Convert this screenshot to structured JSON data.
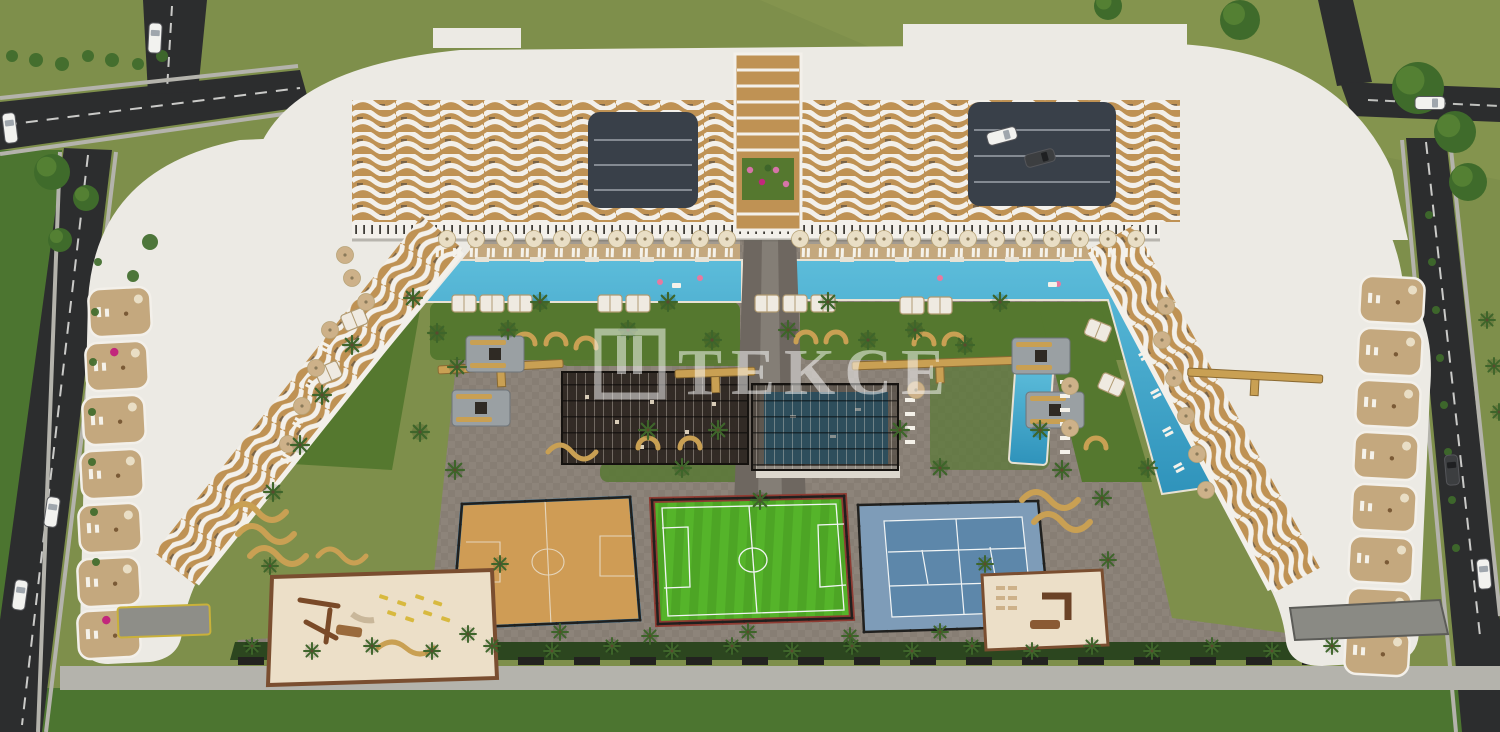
{
  "watermark": {
    "text": "TEKCE"
  },
  "colors": {
    "grass": "#7e8f4b",
    "grassLight": "#8a9a52",
    "lawn": "#4c7530",
    "road": "#2c2d2e",
    "roadLine": "#e6e6e3",
    "sidewalk": "#b4b3ac",
    "building": "#eceae4",
    "facadeTan": "#bf9254",
    "facadeWhite": "#f3f0ea",
    "facadeDark": "#4c463e",
    "atrium": "#394049",
    "arcadeTick": "#3f3c37",
    "hedge": "#2c461f",
    "garden": "#55782f",
    "palm": "#3e652a",
    "tree": "#3f6b2b",
    "treeHi": "#69953c",
    "deck": "#c4a87e",
    "pavement": "#8d847a",
    "path2": "#6e6760",
    "walk": "#a39b90",
    "pool": "#53b5d6",
    "poolDeep": "#2f93bb",
    "poolEdge": "#e8e2d4",
    "canopy": "#2f2822",
    "canopyPool": "#2e6d8c",
    "cabana": "#efeae1",
    "cabanaTrim": "#b09a72",
    "umbrella": "#e9dec5",
    "umbrellaTan": "#cdb189",
    "bench": "#c9a053",
    "firepad": "#9aa0a3",
    "fire": "#2f2a24",
    "sand": "#ecdfc8",
    "sandBorder": "#7a4e30",
    "bball": "#cf9c55",
    "bballEdge": "#3a7fae",
    "football": "#55b42a",
    "footballStripe": "#4da525",
    "footballEdge": "#8e3b32",
    "tennisOuter": "#7e9cb8",
    "tennisInner": "#5d87aa",
    "lineWhite": "#f2f5f5",
    "fence": "#20201e",
    "carWhite": "#f2f2ef",
    "carDark": "#3c3e40",
    "accentPink": "#e8799f",
    "accentMagenta": "#c2267c",
    "yellow": "#d8b93f",
    "flowerPink": "#d674a8",
    "watermark": "#ffffff"
  }
}
